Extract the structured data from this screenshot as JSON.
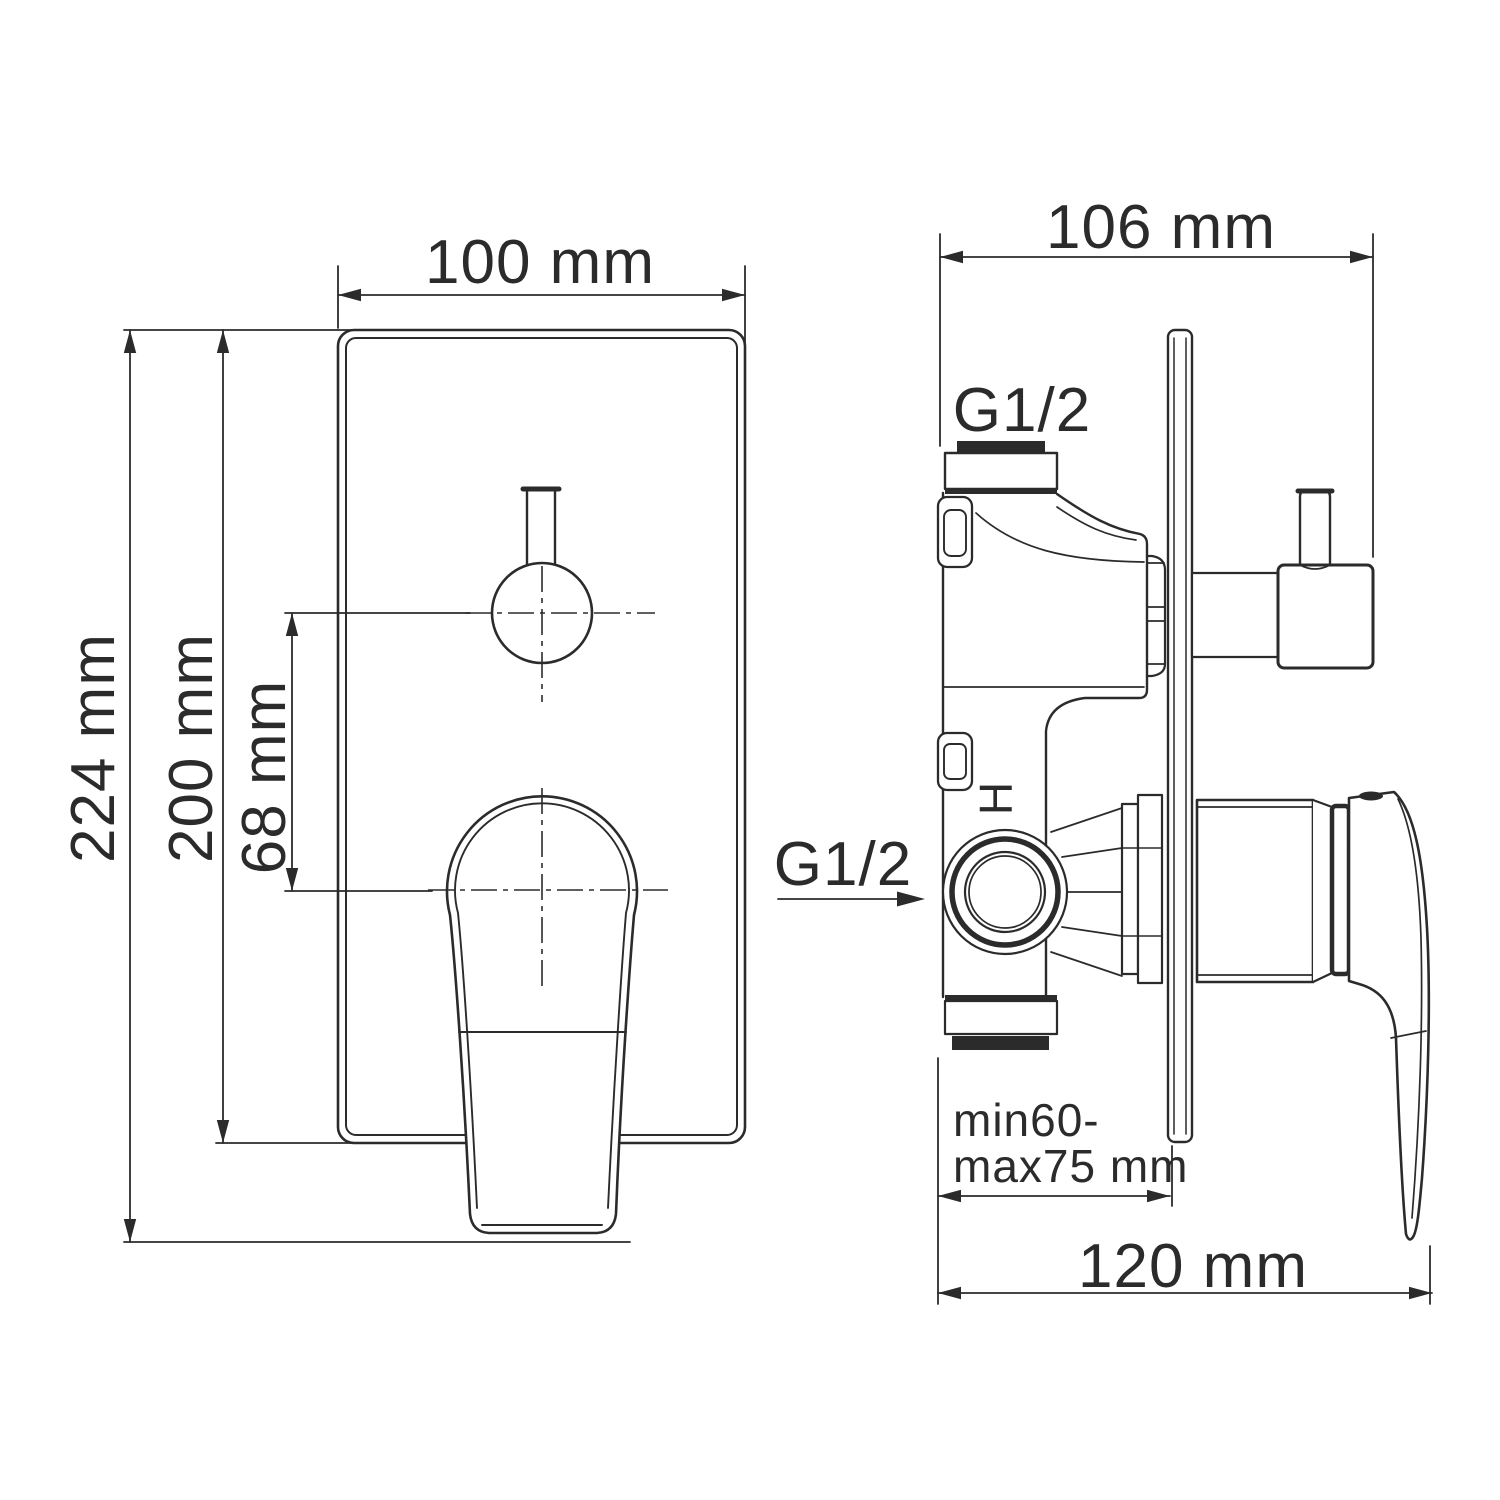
{
  "drawing": {
    "type": "technical-dimension-drawing",
    "subject": "concealed shower mixer valve, front and side views",
    "colors": {
      "line": "#2b2b2b",
      "background": "#ffffff"
    },
    "front_view": {
      "width_label": "100 mm",
      "overall_height_label": "224 mm",
      "plate_height_label": "200 mm",
      "diverter_offset_label": "68 mm"
    },
    "side_view": {
      "depth_label": "106 mm",
      "overall_depth_label": "120 mm",
      "embed_depth_label_line1": "min60-",
      "embed_depth_label_line2": "max75 mm",
      "top_port_thread_label": "G1/2",
      "side_port_thread_label": "G1/2",
      "hot_marking": "H"
    }
  }
}
